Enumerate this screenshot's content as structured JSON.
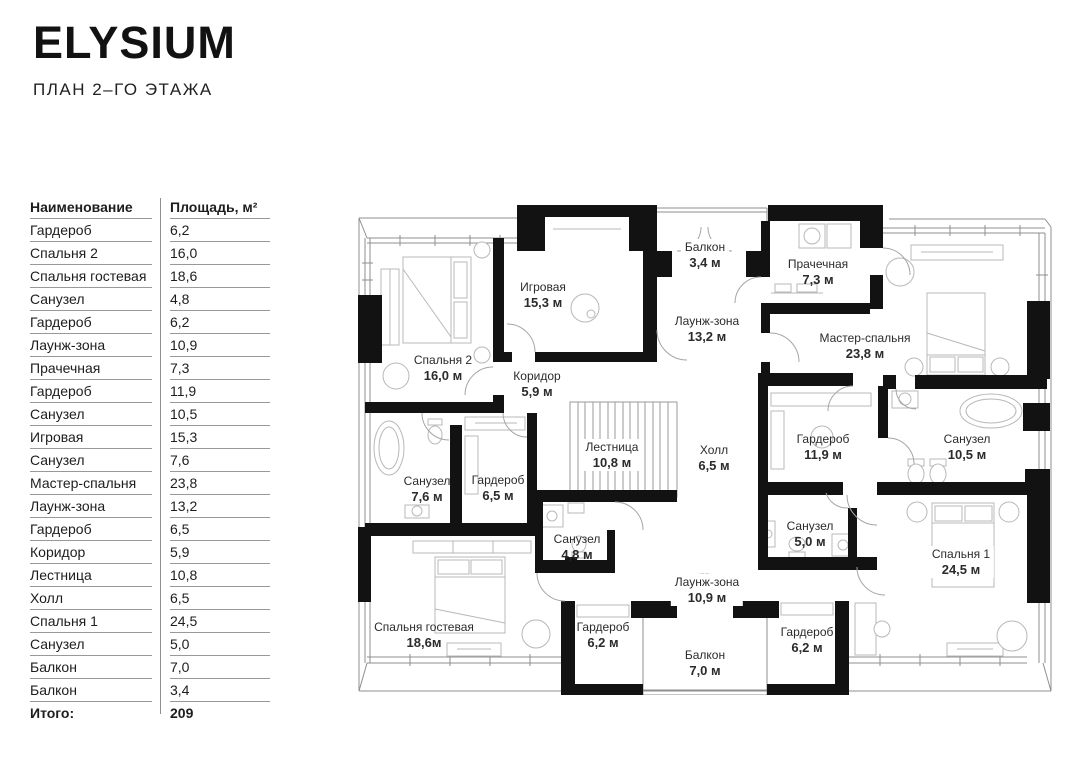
{
  "brand": {
    "logo": "ELYSIUM",
    "subtitle": "ПЛАН 2–ГО ЭТАЖА"
  },
  "colors": {
    "wall": "#121212",
    "thin_line": "#8f8f8f",
    "furniture_line": "#b8b8b8",
    "text": "#2b2b2b"
  },
  "table": {
    "header": {
      "name": "Наименование",
      "area": "Площадь, м²"
    },
    "rows": [
      {
        "name": "Гардероб",
        "area": "6,2"
      },
      {
        "name": "Спальня 2",
        "area": "16,0"
      },
      {
        "name": "Спальня гостевая",
        "area": "18,6"
      },
      {
        "name": "Санузел",
        "area": "4,8"
      },
      {
        "name": "Гардероб",
        "area": "6,2"
      },
      {
        "name": "Лаунж-зона",
        "area": "10,9"
      },
      {
        "name": "Прачечная",
        "area": "7,3"
      },
      {
        "name": "Гардероб",
        "area": "11,9"
      },
      {
        "name": "Санузел",
        "area": "10,5"
      },
      {
        "name": "Игровая",
        "area": "15,3"
      },
      {
        "name": "Санузел",
        "area": "7,6"
      },
      {
        "name": "Мастер-спальня",
        "area": "23,8"
      },
      {
        "name": "Лаунж-зона",
        "area": "13,2"
      },
      {
        "name": "Гардероб",
        "area": "6,5"
      },
      {
        "name": "Коридор",
        "area": "5,9"
      },
      {
        "name": "Лестница",
        "area": "10,8"
      },
      {
        "name": "Холл",
        "area": "6,5"
      },
      {
        "name": "Спальня 1",
        "area": "24,5"
      },
      {
        "name": "Санузел",
        "area": "5,0"
      },
      {
        "name": "Балкон",
        "area": "7,0"
      },
      {
        "name": "Балкон",
        "area": "3,4"
      }
    ],
    "total": {
      "label": "Итого:",
      "value": "209"
    }
  },
  "plan": {
    "rooms": [
      {
        "name": "Спальня 2",
        "area": "16,0 м"
      },
      {
        "name": "Игровая",
        "area": "15,3 м"
      },
      {
        "name": "Балкон",
        "area": "3,4 м"
      },
      {
        "name": "Прачечная",
        "area": "7,3 м"
      },
      {
        "name": "Мастер-спальня",
        "area": "23,8 м"
      },
      {
        "name": "Лаунж-зона",
        "area": "13,2 м"
      },
      {
        "name": "Коридор",
        "area": "5,9 м"
      },
      {
        "name": "Лестница",
        "area": "10,8 м"
      },
      {
        "name": "Холл",
        "area": "6,5 м"
      },
      {
        "name": "Гардероб",
        "area": "11,9 м"
      },
      {
        "name": "Санузел",
        "area": "10,5 м"
      },
      {
        "name": "Санузел",
        "area": "7,6 м"
      },
      {
        "name": "Гардероб",
        "area": "6,5 м"
      },
      {
        "name": "Санузел",
        "area": "4,8 м"
      },
      {
        "name": "Санузел",
        "area": "5,0 м"
      },
      {
        "name": "Спальня 1",
        "area": "24,5 м"
      },
      {
        "name": "Спальня гостевая",
        "area": "18,6м"
      },
      {
        "name": "Гардероб",
        "area": "6,2 м"
      },
      {
        "name": "Гардероб",
        "area": "6,2 м"
      },
      {
        "name": "Лаунж-зона",
        "area": "10,9 м"
      },
      {
        "name": "Балкон",
        "area": "7,0 м"
      }
    ]
  }
}
